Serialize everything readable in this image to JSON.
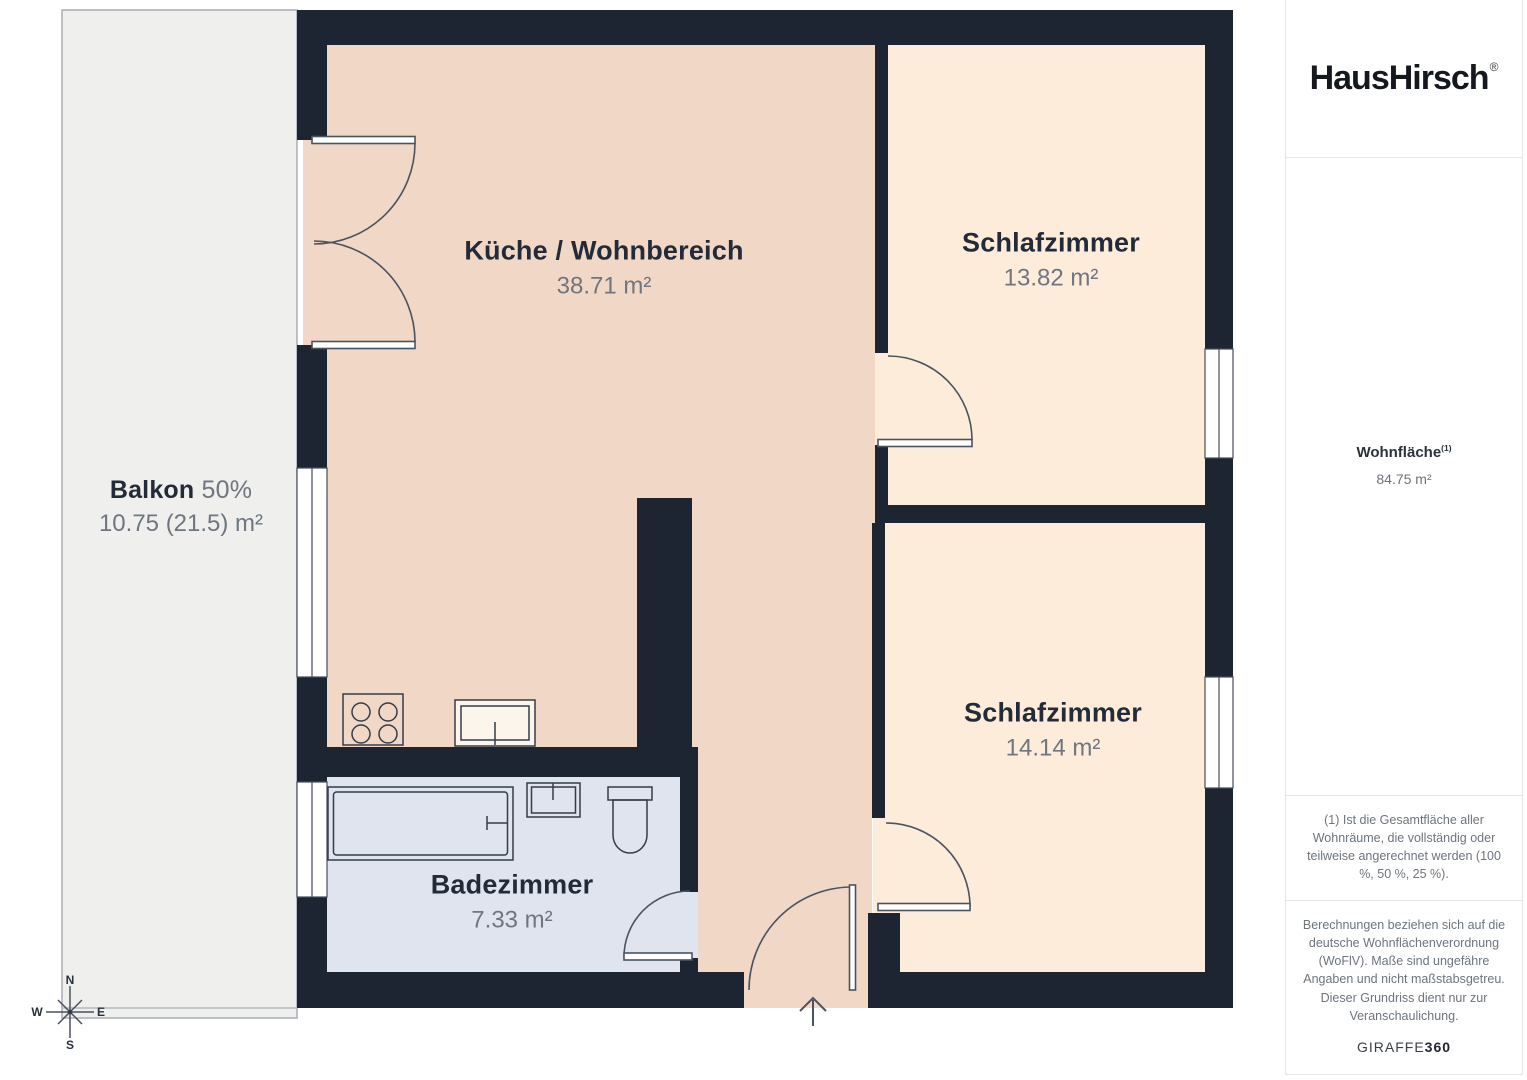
{
  "brand": {
    "logo": "HausHirsch",
    "reg": "®"
  },
  "sidebar": {
    "living_area_label": "Wohnfläche",
    "living_area_footnote_mark": "(1)",
    "living_area_value": "84.75 m²",
    "footnote": "(1) Ist die Gesamtfläche aller Wohnräume, die vollständig oder teilweise angerechnet werden (100 %, 50 %, 25 %).",
    "disclaimer": "Berechnungen beziehen sich auf die deutsche Wohnflächenverordnung (WoFlV). Maße sind ungefähre Angaben und nicht maßstabsgetreu. Dieser Grundriss dient nur zur Veranschaulichung.",
    "vendor_name": "GIRAFFE",
    "vendor_suffix": "360"
  },
  "rooms": {
    "kitchen": {
      "name": "Küche / Wohnbereich",
      "area": "38.71 m²"
    },
    "bedroom_top": {
      "name": "Schlafzimmer",
      "area": "13.82 m²"
    },
    "bedroom_bottom": {
      "name": "Schlafzimmer",
      "area": "14.14 m²"
    },
    "bathroom": {
      "name": "Badezimmer",
      "area": "7.33 m²"
    },
    "balcony": {
      "name": "Balkon",
      "share": "50%",
      "area": "10.75 (21.5) m²"
    }
  },
  "compass": {
    "n": "N",
    "s": "S",
    "e": "E",
    "w": "W"
  },
  "colors": {
    "wall": "#1d2532",
    "living": "#f1d7c5",
    "bedroom": "#fdecda",
    "bathroom": "#dfe4ee",
    "balcony": "#efefed",
    "outline": "#4a5360",
    "label_dark": "#232b39",
    "label_gray": "#6f7680"
  }
}
